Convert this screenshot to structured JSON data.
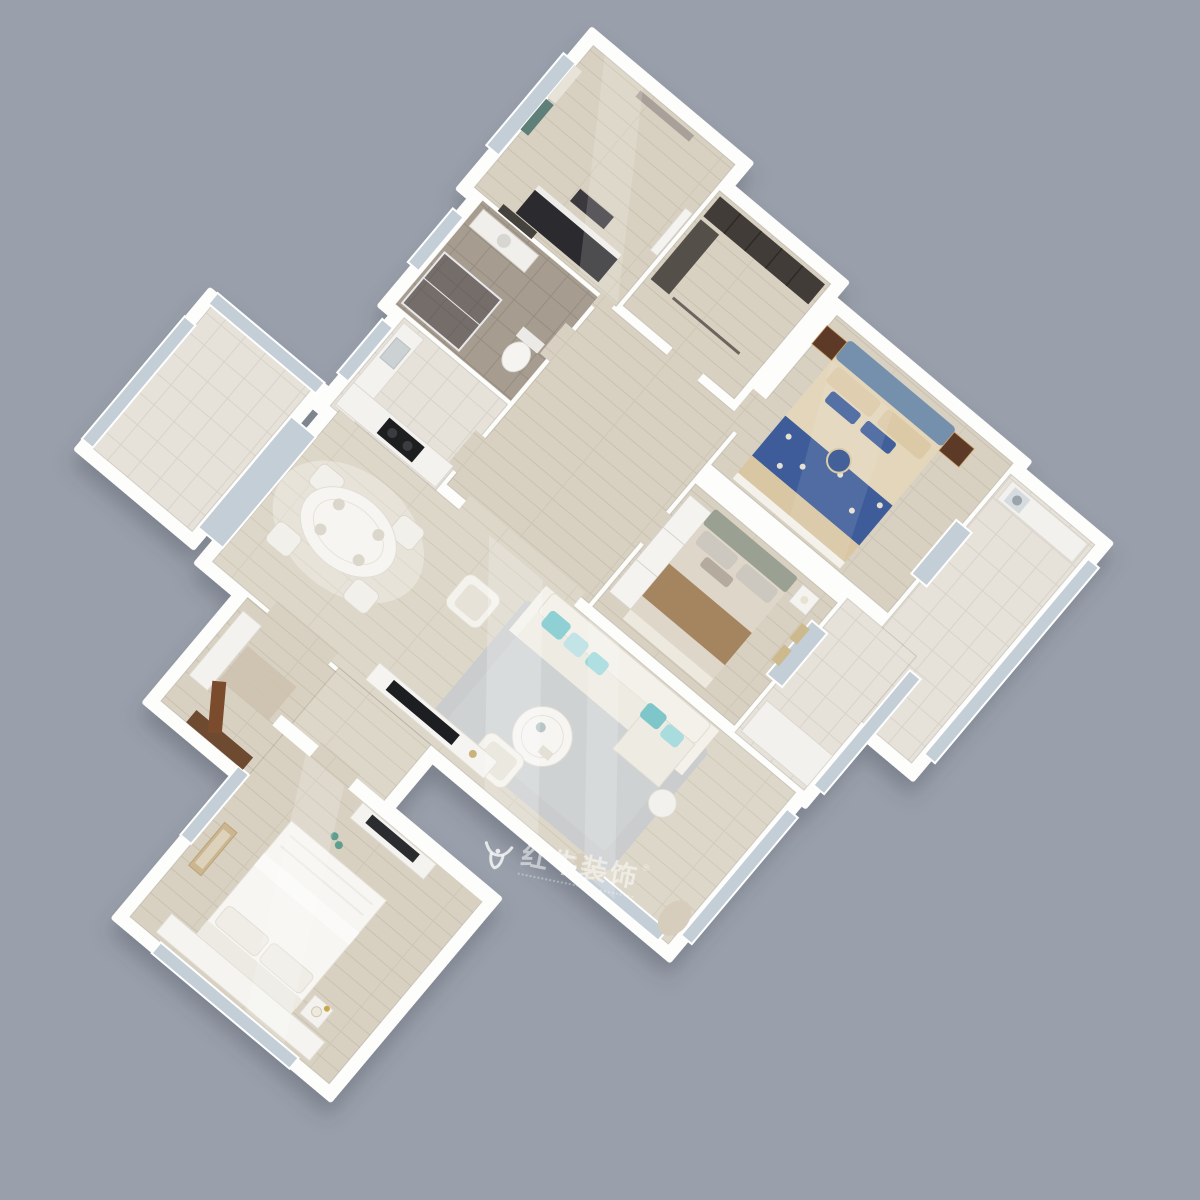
{
  "scene": {
    "type": "3d-isometric-floorplan-render",
    "background_color": "#9aa0ab",
    "plan_rotation_deg": 40,
    "watermark": {
      "logo": "bull-logo",
      "text": "红牛装饰",
      "registered_mark": "®"
    },
    "palette": {
      "walls": "#fdfdfb",
      "wood_floor": "#d8d1c2",
      "living_floor": "#ddd7c9",
      "bathroom_tile": "#a79c90",
      "balcony_tile": "#e6e2da",
      "window_glass": "#c3ced6",
      "master_bed_navy": "#3d5c99",
      "master_bed_beige": "#d9c6a2",
      "master_headboard_blue": "#7590ac",
      "nightstand_brown": "#5d3a27",
      "sofa_cream": "#f1efe8",
      "pillow_teal": "#8ed0d4",
      "rug_gray": "#caccce",
      "piano_black": "#2b2a2e",
      "door_brown": "#7b4b2e",
      "curtain_teal": "#5e8078"
    },
    "rooms": [
      {
        "id": "piano-room",
        "furniture": [
          "upright-piano",
          "piano-bench",
          "air-conditioner",
          "curtained-window",
          "wall-art"
        ]
      },
      {
        "id": "walk-in-closet",
        "furniture": [
          "dark-wardrobe",
          "side-cabinet",
          "clothes-rail"
        ]
      },
      {
        "id": "master-bedroom",
        "furniture": [
          "double-bed-navy-beige",
          "blue-headboard",
          "nightstand-left",
          "nightstand-right",
          "round-pillow"
        ]
      },
      {
        "id": "east-balcony",
        "furniture": [
          "storage-cabinets",
          "washer",
          "floor-to-ceiling-windows"
        ]
      },
      {
        "id": "bathroom",
        "furniture": [
          "glass-shower",
          "toilet",
          "vanity",
          "wall-art"
        ]
      },
      {
        "id": "kitchen",
        "furniture": [
          "l-shaped-counter",
          "cooktop",
          "sink"
        ]
      },
      {
        "id": "hallway",
        "furniture": []
      },
      {
        "id": "second-bedroom",
        "furniture": [
          "double-bed-beige",
          "brown-throw",
          "white-wardrobe",
          "nightstand",
          "wall-frames"
        ]
      },
      {
        "id": "dining-area",
        "furniture": [
          "oval-dining-table",
          "dining-chairs"
        ]
      },
      {
        "id": "living-room",
        "furniture": [
          "white-sofa",
          "teal-pillows",
          "round-coffee-table",
          "area-rug",
          "armchair",
          "lounge-chair",
          "tv-console",
          "side-table",
          "corner-curtains"
        ]
      },
      {
        "id": "west-balcony",
        "furniture": [
          "window-wall"
        ]
      },
      {
        "id": "entry",
        "furniture": [
          "open-entry-door",
          "shoe-cabinet",
          "floor-mat"
        ]
      },
      {
        "id": "third-bedroom",
        "furniture": [
          "double-bed-white",
          "nightstand-lamp",
          "leaning-art",
          "desk-with-panel",
          "bay-window-bench",
          "slippers"
        ]
      }
    ]
  }
}
